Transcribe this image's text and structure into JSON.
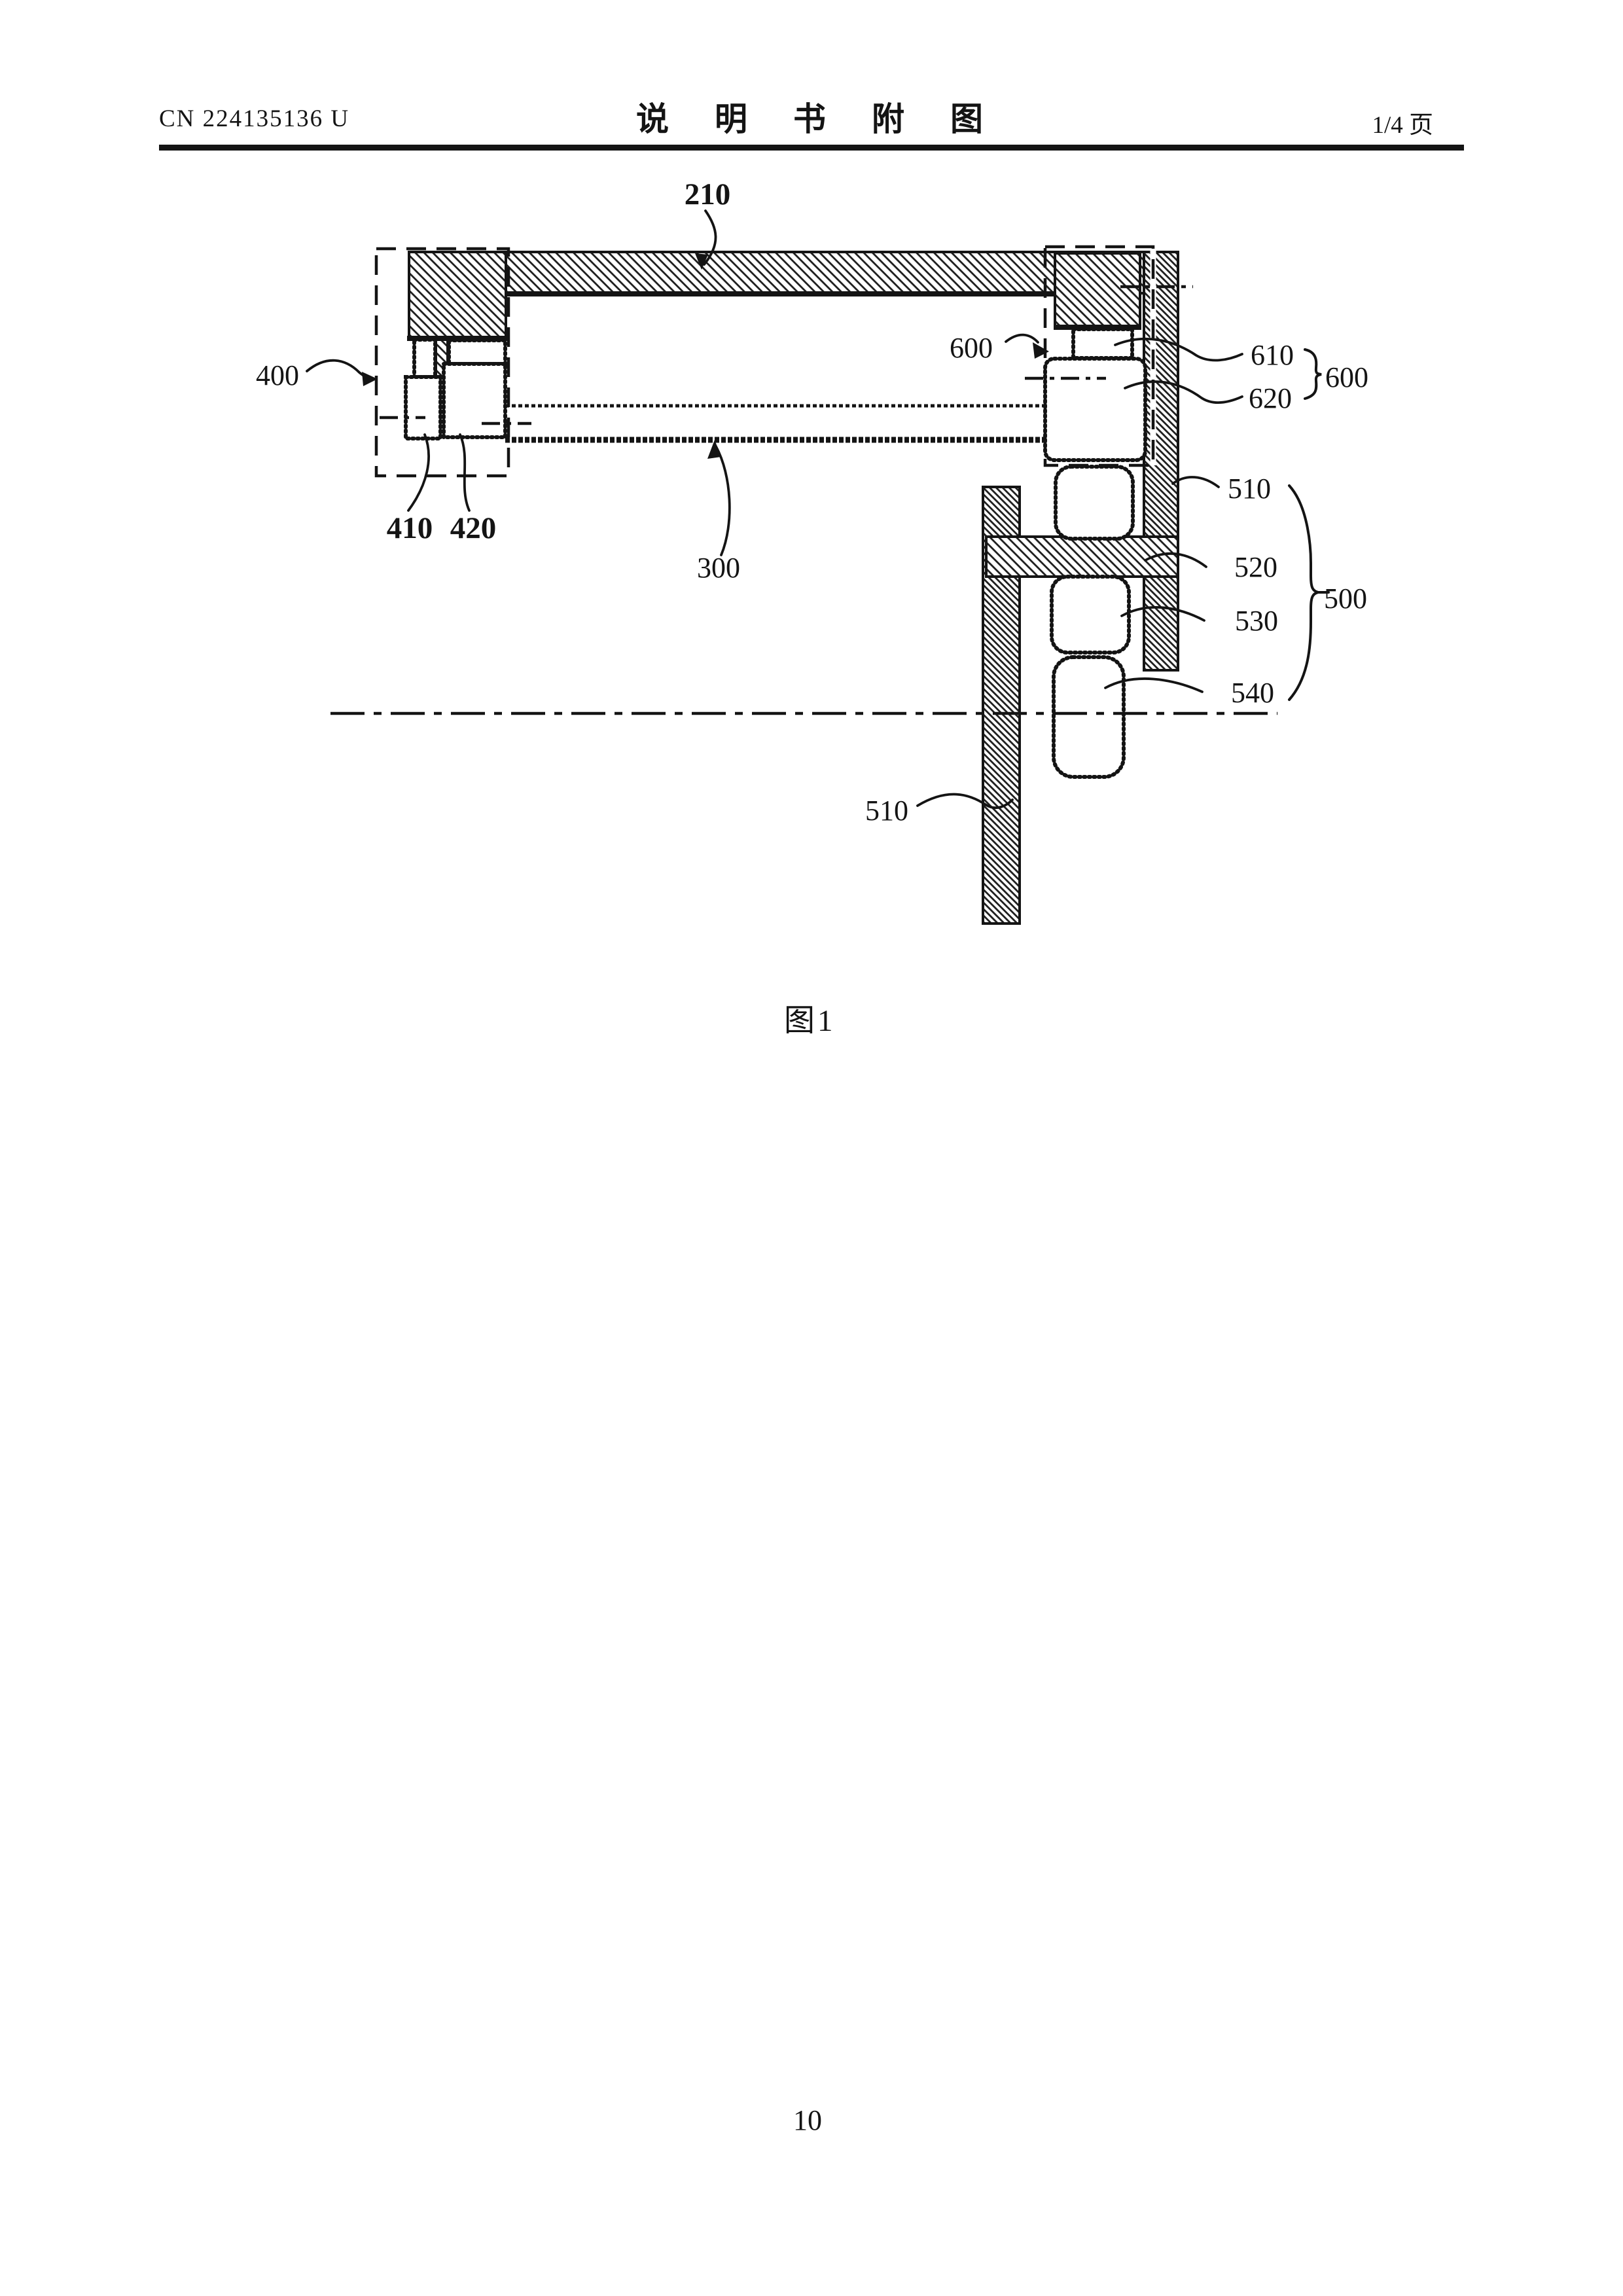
{
  "meta": {
    "ink_color": "#141414",
    "paper_color": "#ffffff"
  },
  "header": {
    "doc_number": "CN 224135136 U",
    "title": "说明书附图",
    "page_indicator": "1/4 页"
  },
  "figure": {
    "caption": "图1",
    "labels": {
      "n210": "210",
      "n300": "300",
      "n400": "400",
      "n410": "410",
      "n420": "420",
      "n500": "500",
      "n510_upper": "510",
      "n510_lower": "510",
      "n520": "520",
      "n530": "530",
      "n540": "540",
      "n600_left": "600",
      "n600_right": "600",
      "n610": "610",
      "n620": "620"
    }
  },
  "footer": {
    "page_number": "10"
  }
}
